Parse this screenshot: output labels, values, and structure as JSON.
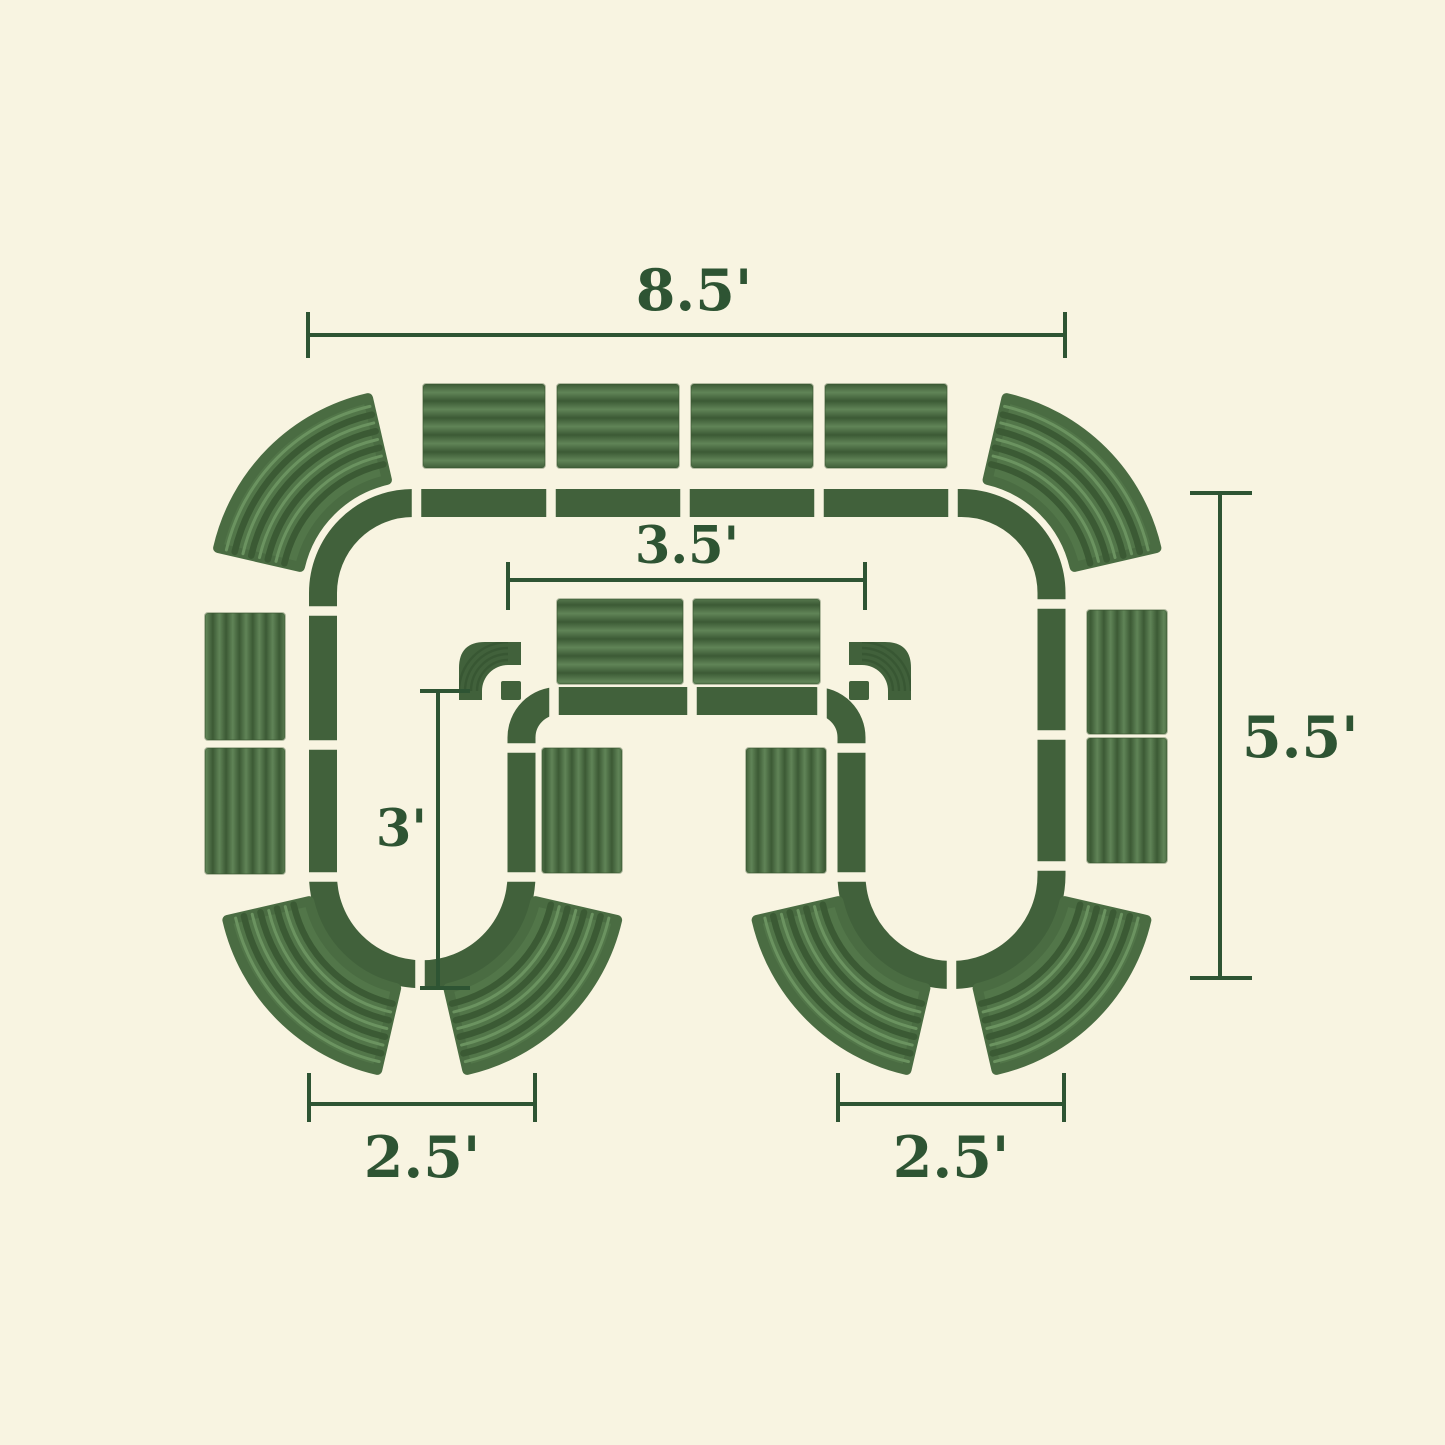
{
  "figure": {
    "kind": "modular-garden-bed-layout-plan",
    "units": "feet",
    "background_color": "#f8f4e1",
    "track_color": "#41613b",
    "panel_dark_color": "#3c5a35",
    "panel_light_color": "#608457",
    "fan_color": "#527649",
    "dimension_color": "#2e5433",
    "dimensions": {
      "overall_width": {
        "label": "8.5'"
      },
      "overall_height": {
        "label": "5.5'"
      },
      "inner_span": {
        "label": "3.5'"
      },
      "inner_depth": {
        "label": "3'"
      },
      "left_opening": {
        "label": "2.5'"
      },
      "right_opening": {
        "label": "2.5'"
      }
    },
    "pieces": {
      "straight_panels": 12,
      "curved_corner_panels": 6,
      "corner_elbows": 2
    }
  }
}
